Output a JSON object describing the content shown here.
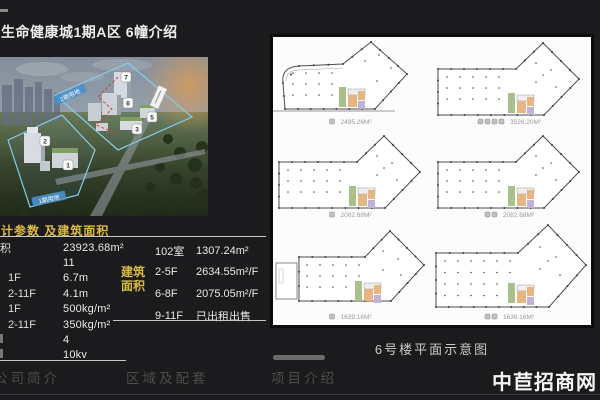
{
  "title": "生命健康城1期A区 6幢介绍",
  "rendering": {
    "badges": [
      "7",
      "6",
      "5",
      "3",
      "2",
      "1"
    ],
    "ribbon_phase2": "2期用地",
    "ribbon_phase1": "1期用地"
  },
  "params_table": {
    "header": "计参数 及建筑面积",
    "rows": [
      {
        "label": "积",
        "value": "23923.68m²"
      },
      {
        "label": "",
        "value": "11"
      },
      {
        "label": "1F",
        "value": "6.7m"
      },
      {
        "label": "2-11F",
        "value": "4.1m"
      },
      {
        "label": "1F",
        "value": "500kg/m²"
      },
      {
        "label": "2-11F",
        "value": "350kg/m²"
      },
      {
        "label": "",
        "value": "4"
      },
      {
        "label": "",
        "value": "10kv"
      }
    ]
  },
  "area_table": {
    "label": "建筑面积",
    "rows": [
      {
        "floor": "102室",
        "value": "1307.24m²"
      },
      {
        "floor": "2-5F",
        "value": "2634.55m²/F"
      },
      {
        "floor": "6-8F",
        "value": "2075.05m²/F"
      },
      {
        "floor": "9-11F",
        "value": "已出租出售"
      }
    ]
  },
  "floor_plans": {
    "caption": "6号楼平面示意图",
    "plans": [
      {
        "area": "2495.26M²",
        "icons": 1,
        "variant": "boomerang"
      },
      {
        "area": "3526.20M²",
        "icons": 4,
        "variant": "wing"
      },
      {
        "area": "2082.68M²",
        "icons": 1,
        "variant": "wing"
      },
      {
        "area": "2082.68M²",
        "icons": 2,
        "variant": "wing"
      },
      {
        "area": "1639.16M²",
        "icons": 1,
        "variant": "wing-annex"
      },
      {
        "area": "1639.16M²",
        "icons": 2,
        "variant": "wing-large"
      }
    ]
  },
  "nav": {
    "items": [
      "公司简介",
      "区域及配套",
      "项目介绍"
    ]
  },
  "watermark": "中苣招商网",
  "colors": {
    "accent_yellow": "#d9b945",
    "ribbon_blue": "#4a90c8",
    "plan_green": "#a9c08b",
    "plan_orange": "#e5b583",
    "plan_purple": "#c3b2d8",
    "bg": "#1b1b1d"
  }
}
